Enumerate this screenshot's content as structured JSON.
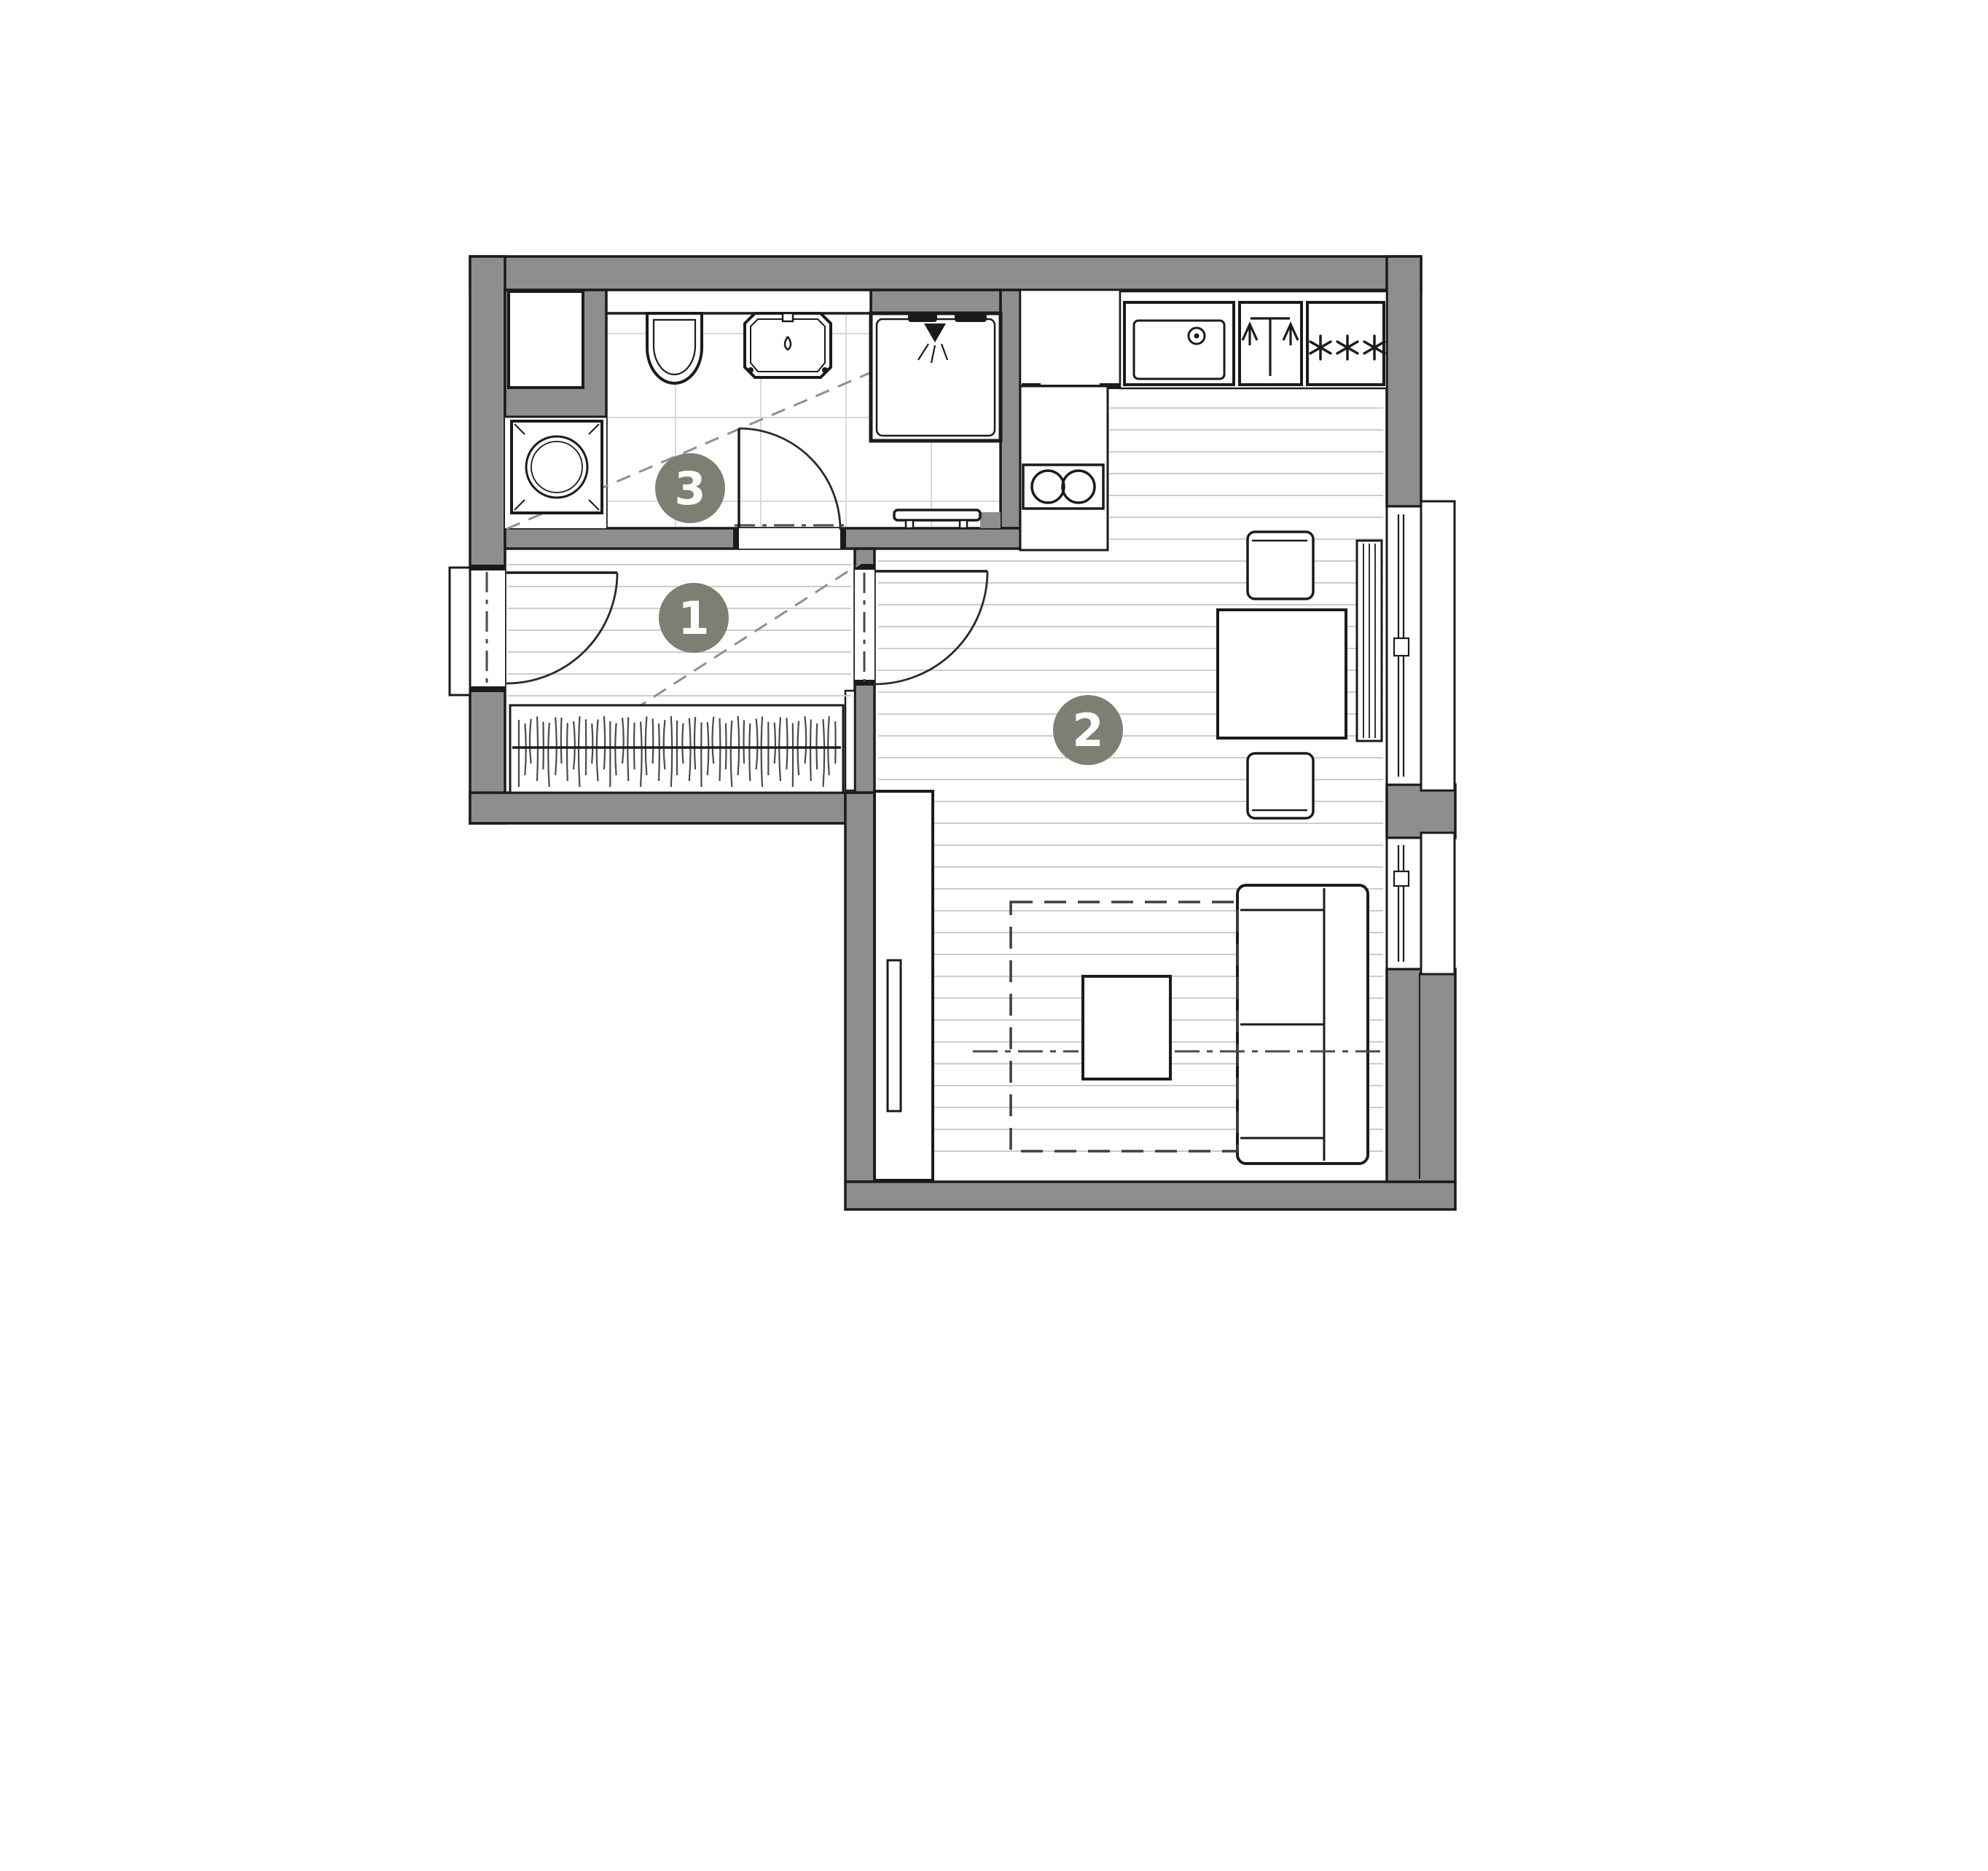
{
  "page": {
    "background": "#ffffff",
    "content": "apartment floor plan"
  },
  "floor_plan": {
    "room_badges": [
      {
        "number": "1"
      },
      {
        "number": "2"
      },
      {
        "number": "3"
      }
    ],
    "freezer_symbol_count": 3,
    "hob_burner_count": 2,
    "window_count": 2,
    "colors": {
      "wall": "#8e8e8e",
      "outline": "#1b1b1b",
      "floor_line": "#cccccc",
      "tile_line": "#d8d8d8",
      "slope_dash": "#909090",
      "badge_fill": "#7c8073",
      "badge_text": "#ffffff",
      "paper": "#ffffff"
    }
  }
}
